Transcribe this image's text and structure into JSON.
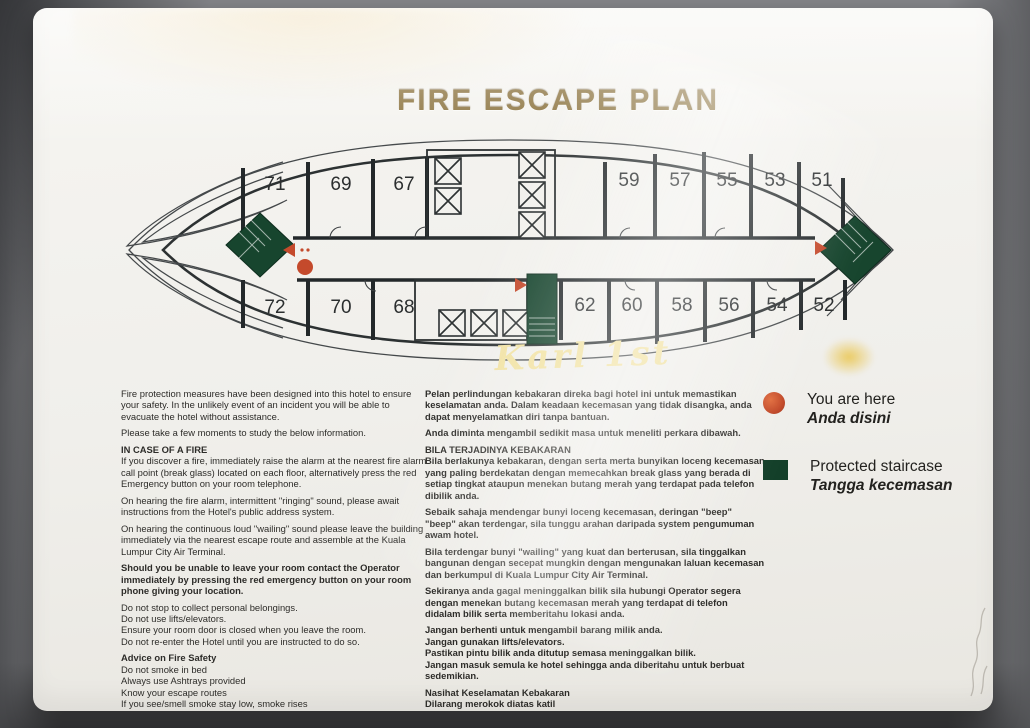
{
  "sign": {
    "title": "FIRE ESCAPE PLAN",
    "watermark": "Karl 1st"
  },
  "floor_plan": {
    "rooms_top": [
      "71",
      "69",
      "67",
      "59",
      "57",
      "55",
      "53",
      "51"
    ],
    "rooms_bottom": [
      "72",
      "70",
      "68",
      "62",
      "60",
      "58",
      "56",
      "54",
      "52"
    ],
    "colors": {
      "staircase_green": "#17452e",
      "marker_red": "#c44a2c",
      "wall_line": "#2c3132",
      "title_gold": "#8a713c",
      "watermark_yellow": "#f1e2a2"
    }
  },
  "instructions_en": {
    "p1": "Fire protection measures have been designed into this hotel to ensure your safety. In the unlikely event of an incident you will be able to evacuate the hotel without assistance.",
    "p2": "Please take a few moments to study the below information.",
    "h1": "IN CASE OF A FIRE",
    "p3": "If you discover a fire, immediately raise the alarm at the nearest fire alarm call point (break glass) located on each floor, alternatively press the red Emergency button on your room telephone.",
    "p4": "On hearing the fire alarm, intermittent \"ringing\" sound, please await instructions from the Hotel's public address system.",
    "p5": "On hearing the continuous loud \"wailing\" sound please leave the building immediately via the nearest escape route and assemble at the Kuala Lumpur City Air Terminal.",
    "p6_bold": "Should you be unable to leave your room contact the Operator immediately by pressing the red emergency button on your room phone giving your location.",
    "rules": [
      "Do not stop to collect personal belongings.",
      "Do not use lifts/elevators.",
      "Ensure your room door is closed when you leave the room.",
      "Do not re-enter the Hotel until you are instructed to do so."
    ],
    "h2": "Advice on Fire Safety",
    "tips": [
      "Do not smoke in bed",
      "Always use Ashtrays provided",
      "Know your escape routes",
      "If you see/smell smoke stay low, smoke rises",
      "Stay calm, don't panic"
    ]
  },
  "instructions_ms": {
    "p1": "Pelan perlindungan kebakaran direka bagi hotel ini untuk memastikan keselamatan anda. Dalam keadaan kecemasan yang tidak disangka, anda dapat menyelamatkan diri tanpa bantuan.",
    "p2": "Anda diminta mengambil sedikit masa untuk meneliti perkara dibawah.",
    "h1": "BILA TERJADINYA KEBAKARAN",
    "p3": "Bila berlakunya kebakaran, dengan serta merta bunyikan loceng kecemasan yang paling berdekatan dengan memecahkan break glass yang berada di setiap tingkat ataupun menekan butang merah yang terdapat pada telefon dibilik anda.",
    "p4": "Sebaik sahaja mendengar bunyi loceng kecemasan, deringan \"beep\" \"beep\" akan terdengar, sila tunggu arahan daripada system pengumuman awam hotel.",
    "p5": "Bila terdengar bunyi \"wailing\" yang kuat dan berterusan, sila tinggalkan bangunan dengan secepat mungkin dengan mengunakan laluan kecemasan dan berkumpul di Kuala Lumpur City Air Terminal.",
    "p6_bold": "Sekiranya anda gagal meninggalkan bilik sila hubungi Operator segera dengan menekan butang kecemasan merah yang terdapat di telefon didalam bilik serta memberitahu lokasi anda.",
    "rules": [
      "Jangan berhenti untuk mengambil barang milik anda.",
      "Jangan gunakan lifts/elevators.",
      "Pastikan pintu bilik anda ditutup semasa meninggalkan bilik.",
      "Jangan masuk semula ke hotel sehingga anda diberitahu untuk berbuat sedemikian."
    ],
    "h2": "Nasihat Keselamatan Kebakaran",
    "tips": [
      "Dilarang merokok diatas katil",
      "Gunakan tempat abu rokok yang disediakan.",
      "Ketahui laluan kecemasan.",
      "Jika ternampak/terhidu asap, meniarap kelantai dibawah aras asap.",
      "Bertenang dan jangan cemas."
    ]
  },
  "legend": {
    "you_are_here": {
      "label_en": "You are here",
      "label_ms": "Anda disini",
      "color": "#c8502e"
    },
    "protected_staircase": {
      "label_en": "Protected staircase",
      "label_ms": "Tangga kecemasan",
      "color": "#133f29"
    }
  }
}
